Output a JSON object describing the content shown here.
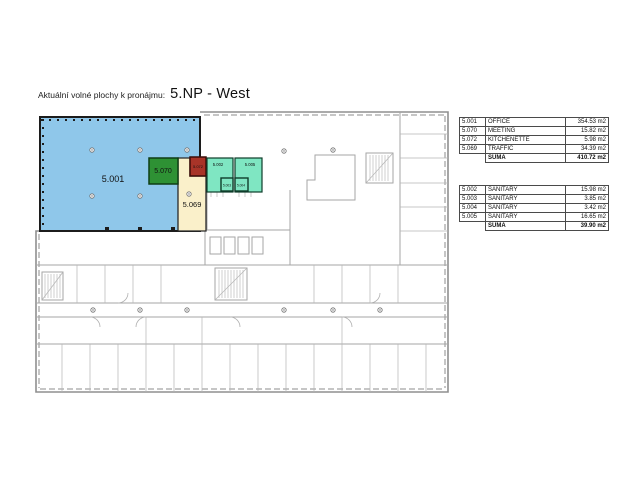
{
  "title": {
    "label": "Aktuální volné plochy k pronájmu:",
    "floor": "5.NP - West"
  },
  "floorplan": {
    "rooms": [
      {
        "id": "5.001",
        "name": "OFFICE",
        "color": "#8FC7EA"
      },
      {
        "id": "5.070",
        "name": "MEETING",
        "color": "#2E9134"
      },
      {
        "id": "5.072",
        "name": "KITCHENETTE",
        "color": "#A83428"
      },
      {
        "id": "5.069",
        "name": "TRAFFIC",
        "color": "#FAF0CA"
      },
      {
        "id": "5.002",
        "name": "SANITARY",
        "color": "#7FE6C2"
      },
      {
        "id": "5.003",
        "name": "SANITARY",
        "color": "#7FE6C2"
      },
      {
        "id": "5.004",
        "name": "SANITARY",
        "color": "#7FE6C2"
      },
      {
        "id": "5.005",
        "name": "SANITARY",
        "color": "#7FE6C2"
      }
    ]
  },
  "tables": {
    "main": {
      "rows": [
        {
          "code": "5.001",
          "name": "OFFICE",
          "area": "354.53 m2"
        },
        {
          "code": "5.070",
          "name": "MEETING",
          "area": "15.82 m2"
        },
        {
          "code": "5.072",
          "name": "KITCHENETTE",
          "area": "5.98 m2"
        },
        {
          "code": "5.069",
          "name": "TRAFFIC",
          "area": "34.39 m2"
        }
      ],
      "suma_label": "SUMA",
      "suma_value": "410.72 m2"
    },
    "sanitary": {
      "rows": [
        {
          "code": "5.002",
          "name": "SANITARY",
          "area": "15.98 m2"
        },
        {
          "code": "5.003",
          "name": "SANITARY",
          "area": "3.85 m2"
        },
        {
          "code": "5.004",
          "name": "SANITARY",
          "area": "3.42 m2"
        },
        {
          "code": "5.005",
          "name": "SANITARY",
          "area": "16.65 m2"
        }
      ],
      "suma_label": "SUMA",
      "suma_value": "39.90 m2"
    }
  }
}
